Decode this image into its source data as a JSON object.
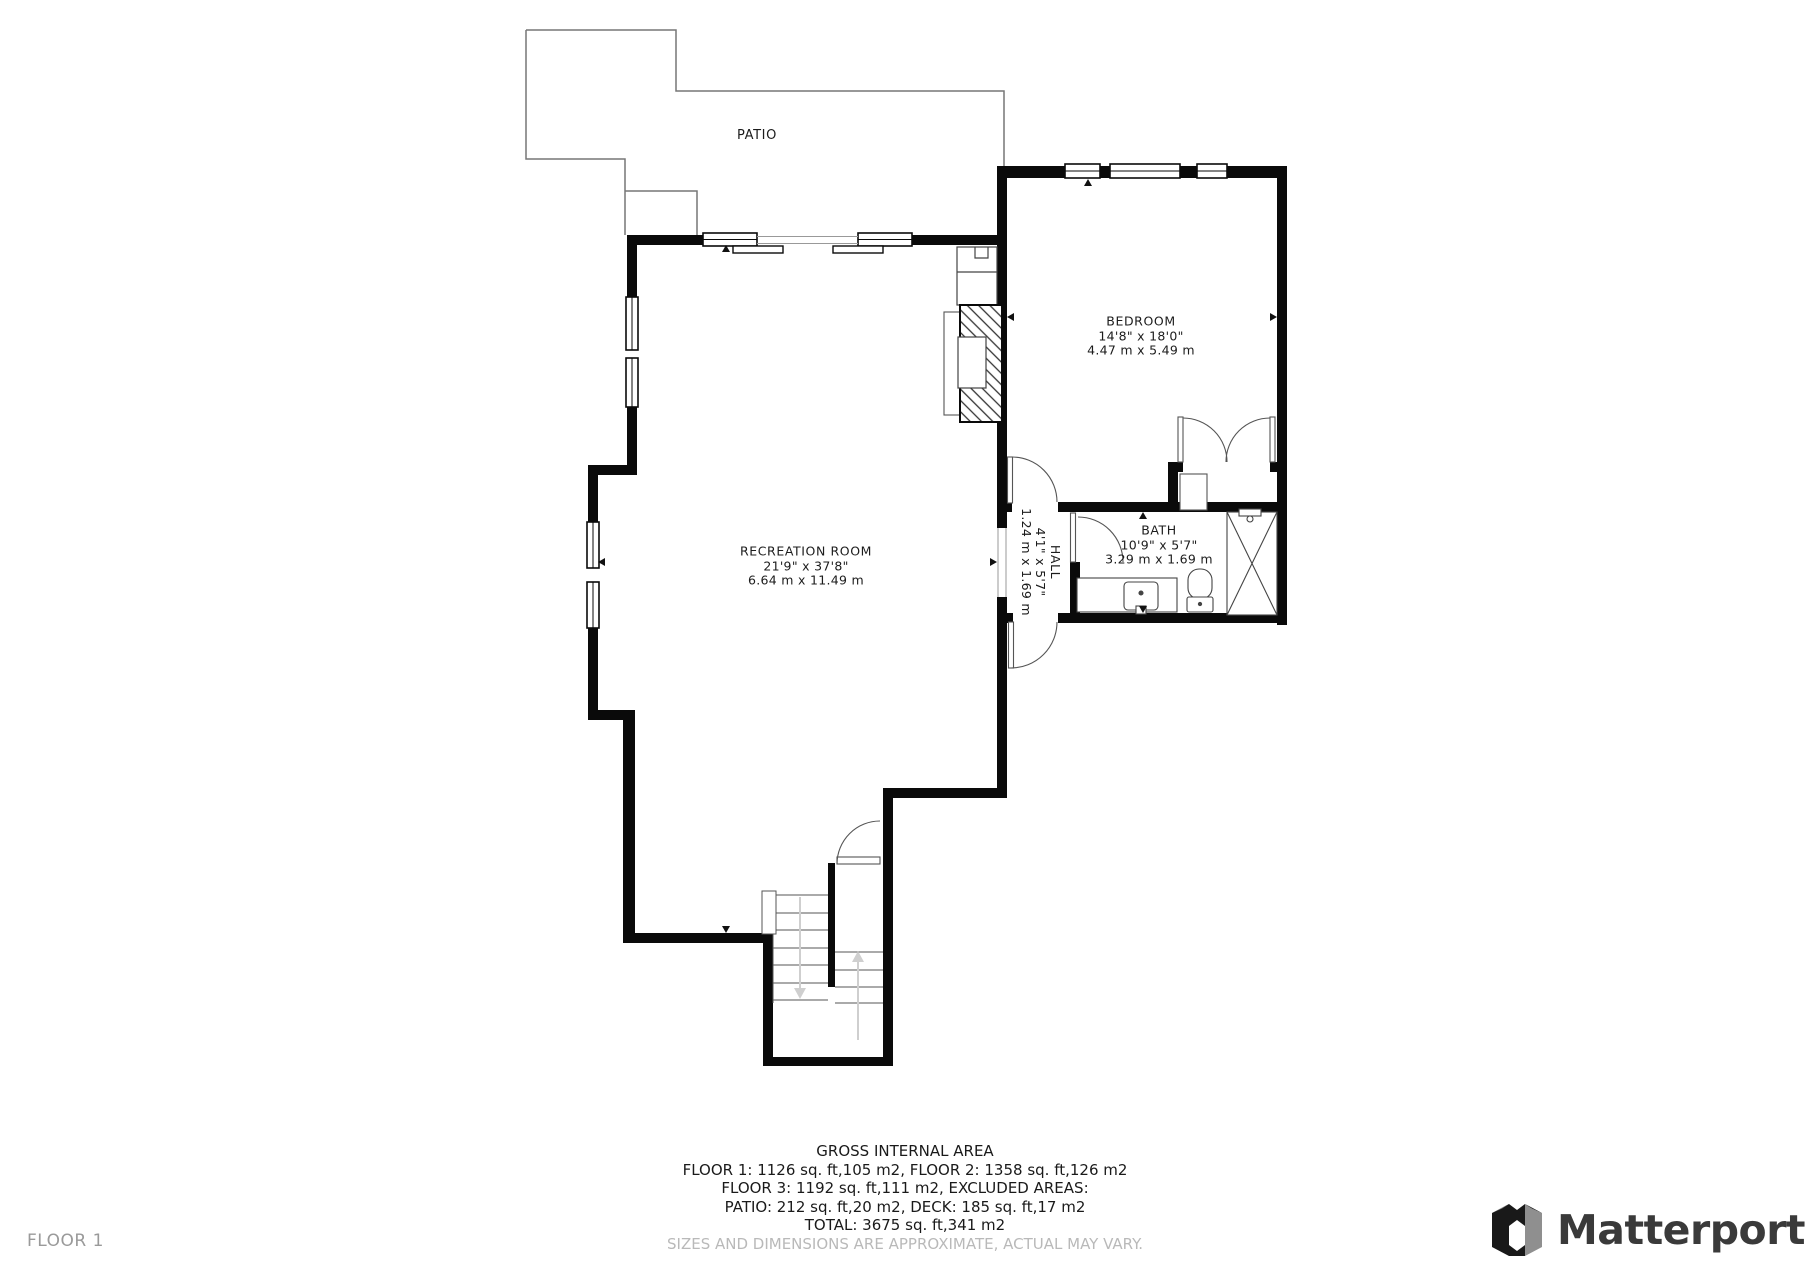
{
  "floor_label": "FLOOR 1",
  "brand": {
    "name": "Matterport",
    "icon": "matterport-m-logo"
  },
  "rooms": {
    "patio": {
      "name": "PATIO"
    },
    "recreation": {
      "name": "RECREATION ROOM",
      "imperial": "21'9\" x 37'8\"",
      "metric": "6.64 m x 11.49 m"
    },
    "bedroom": {
      "name": "BEDROOM",
      "imperial": "14'8\" x 18'0\"",
      "metric": "4.47 m x 5.49 m"
    },
    "hall": {
      "name": "HALL",
      "imperial": "4'1\" x 5'7\"",
      "metric": "1.24 m x 1.69 m"
    },
    "bath": {
      "name": "BATH",
      "imperial": "10'9\" x 5'7\"",
      "metric": "3.29 m x 1.69 m"
    }
  },
  "summary": {
    "title": "GROSS INTERNAL AREA",
    "lines": [
      "FLOOR 1: 1126 sq. ft,105 m2, FLOOR 2: 1358 sq. ft,126 m2",
      "FLOOR 3: 1192 sq. ft,111 m2, EXCLUDED AREAS:",
      "PATIO: 212 sq. ft,20 m2, DECK: 185 sq. ft,17 m2",
      "TOTAL: 3675 sq. ft,341 m2"
    ],
    "disclaimer": "SIZES AND DIMENSIONS ARE APPROXIMATE, ACTUAL MAY VARY."
  },
  "colors": {
    "wall": "#0a0a0a",
    "thin_line": "#555555",
    "patio_outline": "#777777",
    "stair_arrow": "#cfcfcf",
    "muted_text": "#9a9a9a",
    "disclaimer_text": "#b9b9b9",
    "brand_text": "#3a3a3a"
  }
}
